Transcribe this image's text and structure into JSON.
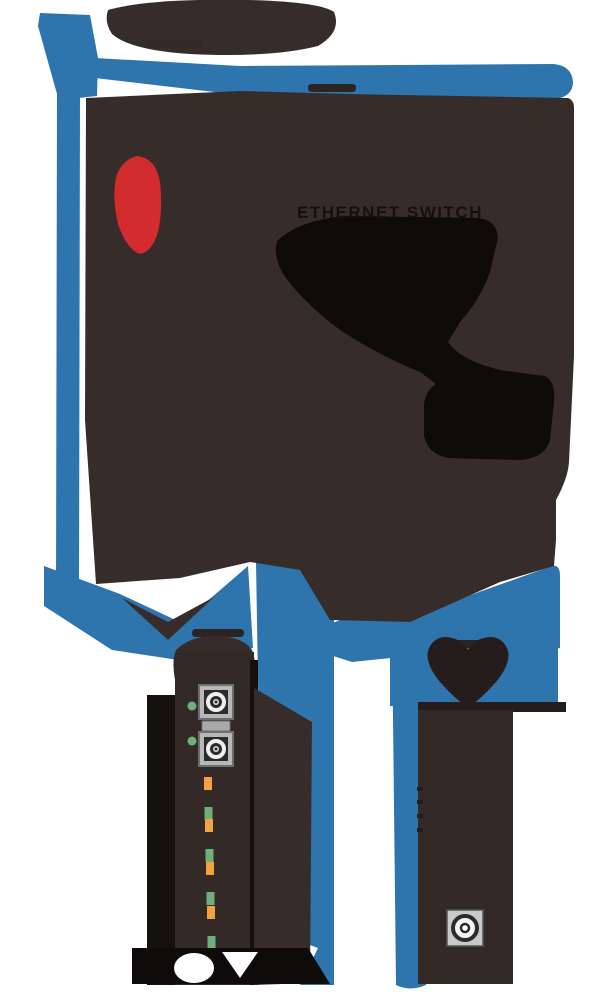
{
  "diagram": {
    "kind": "hardware-dimension-diagram",
    "labels": {
      "product": "ETHERNET SWITCH"
    },
    "views": {
      "top_view": {
        "description": "device top outline with blue dimension arrows on top and left",
        "has_red_logo_mark": true,
        "has_black_ports_silhouette": true
      },
      "front_panel_view": {
        "fiber_ports": [
          {
            "name": "fiber-port-1",
            "port_led_color": "green"
          },
          {
            "name": "fiber-port-2",
            "port_led_color": "green"
          }
        ],
        "status_leds": [
          "orange",
          "green",
          "orange",
          "green",
          "orange",
          "green",
          "orange",
          "green"
        ]
      },
      "side_panel_view": {
        "connector": "dc-power-jack"
      }
    },
    "colors": {
      "background": "#FFFFFF",
      "dimension_blue": "#2E75AE",
      "body_dark": "#362D2B",
      "silhouette_black": "#0E0B0A",
      "logo_red": "#D22C2E",
      "led_green": "#6FB07A",
      "led_orange": "#F2A33F",
      "metal_grey": "#B8B8B8"
    }
  }
}
